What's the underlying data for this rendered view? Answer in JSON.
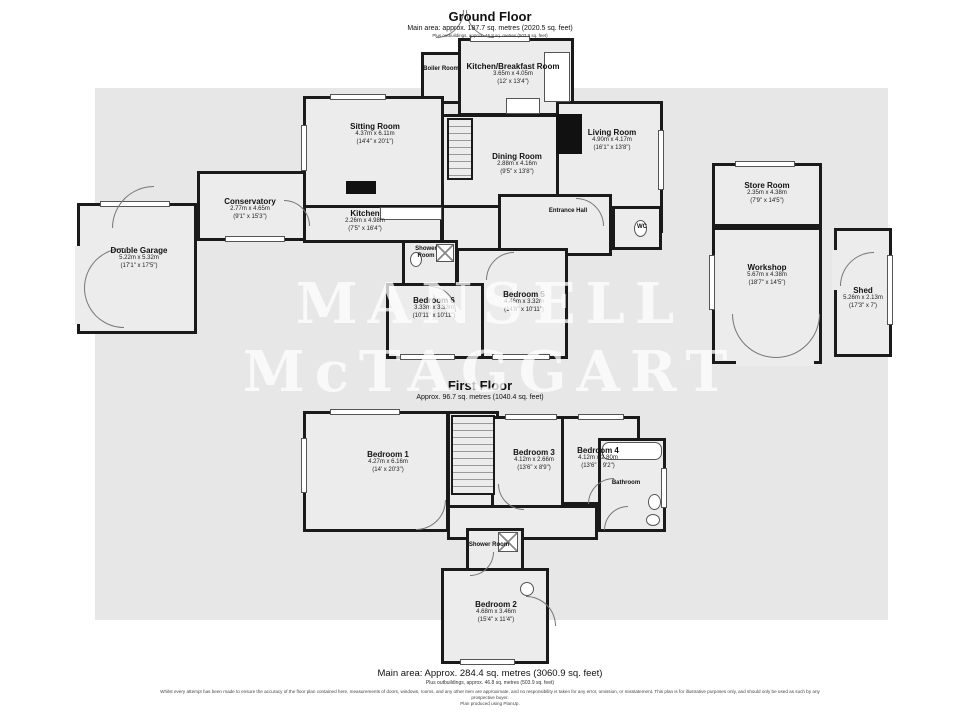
{
  "watermark": {
    "line1": "MANSELL",
    "line2": "McTAGGART"
  },
  "ground_floor": {
    "title": "Ground Floor",
    "area": "Main area: approx. 187.7 sq. metres (2020.5 sq. feet)",
    "outbuildings": "Plus outbuildings, approx. 46.8 sq. metres (503.9 sq. feet)",
    "rooms": {
      "boiler": {
        "name": "Boiler Room"
      },
      "kitchen_breakfast": {
        "name": "Kitchen/Breakfast Room",
        "metric": "3.65m x 4.05m",
        "imperial": "(12' x 13'4\")"
      },
      "sitting_room": {
        "name": "Sitting Room",
        "metric": "4.37m x 6.11m",
        "imperial": "(14'4\" x 20'1\")"
      },
      "living_room": {
        "name": "Living Room",
        "metric": "4.90m x 4.17m",
        "imperial": "(16'1\" x 13'8\")"
      },
      "dining_room": {
        "name": "Dining Room",
        "metric": "2.88m x 4.16m",
        "imperial": "(9'5\" x 13'8\")"
      },
      "conservatory": {
        "name": "Conservatory",
        "metric": "2.77m x 4.65m",
        "imperial": "(9'1\" x 15'3\")"
      },
      "kitchen": {
        "name": "Kitchen",
        "metric": "2.26m x 4.98m",
        "imperial": "(7'5\" x 16'4\")"
      },
      "entrance_hall": {
        "name": "Entrance Hall"
      },
      "wc": {
        "name": "WC"
      },
      "double_garage": {
        "name": "Double Garage",
        "metric": "5.22m x 5.32m",
        "imperial": "(17'1\" x 17'5\")"
      },
      "shower_room": {
        "name": "Shower Room"
      },
      "bedroom_6": {
        "name": "Bedroom 6",
        "metric": "3.33m x 3.33m",
        "imperial": "(10'11\" x 10'11\")"
      },
      "bedroom_5": {
        "name": "Bedroom 5",
        "metric": "4.46m x 3.32m",
        "imperial": "(14'8\" x 10'11\")"
      },
      "store_room": {
        "name": "Store Room",
        "metric": "2.35m x 4.38m",
        "imperial": "(7'9\" x 14'5\")"
      },
      "workshop": {
        "name": "Workshop",
        "metric": "5.67m x 4.38m",
        "imperial": "(18'7\" x 14'5\")"
      },
      "shed": {
        "name": "Shed",
        "metric": "5.26m x 2.13m",
        "imperial": "(17'3\" x 7')"
      }
    }
  },
  "first_floor": {
    "title": "First Floor",
    "area": "Approx. 96.7 sq. metres (1040.4 sq. feet)",
    "rooms": {
      "bedroom_1": {
        "name": "Bedroom 1",
        "metric": "4.27m x 6.16m",
        "imperial": "(14' x 20'3\")"
      },
      "bedroom_3": {
        "name": "Bedroom 3",
        "metric": "4.12m x 2.66m",
        "imperial": "(13'6\" x 8'9\")"
      },
      "bedroom_4": {
        "name": "Bedroom 4",
        "metric": "4.12m x 2.80m",
        "imperial": "(13'6\" x 9'2\")"
      },
      "bathroom": {
        "name": "Bathroom"
      },
      "shower_room": {
        "name": "Shower Room"
      },
      "bedroom_2": {
        "name": "Bedroom 2",
        "metric": "4.68m x 3.46m",
        "imperial": "(15'4\" x 11'4\")"
      }
    }
  },
  "footer": {
    "main_area": "Main area: Approx. 284.4 sq. metres (3060.9 sq. feet)",
    "outbuildings": "Plus outbuildings, approx. 46.8 sq. metres (503.9 sq. feet)",
    "disclaimer": "Whilst every attempt has been made to ensure the accuracy of the floor plan contained here, measurements of doors, windows, rooms, and any other item are approximate, and no responsibility is taken for any error, omission, or misstatement. This plan is for illustrative purposes only, and should only be used as such by any prospective buyer.",
    "produced": "Plan produced using PlanUp."
  }
}
